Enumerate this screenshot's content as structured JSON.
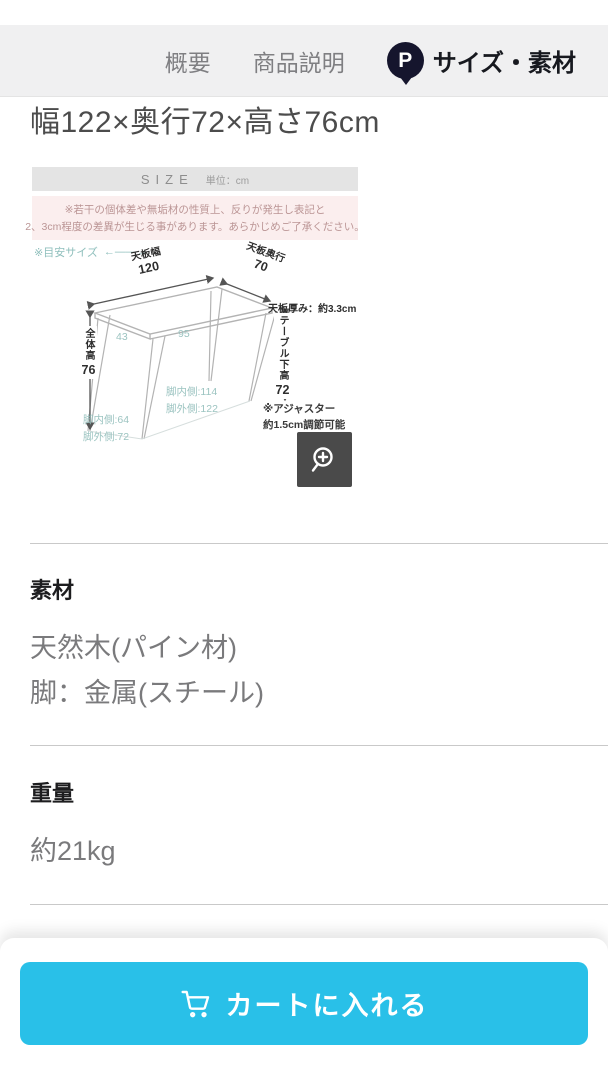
{
  "nav": {
    "tabs": [
      {
        "label": "概要"
      },
      {
        "label": "商品説明"
      },
      {
        "label": "サイズ・素材"
      }
    ],
    "point_badge": "P"
  },
  "size_section": {
    "dimensions_text": "幅122×奥行72×高さ76cm",
    "figure": {
      "header_title": "SIZE",
      "header_unit": "単位：cm",
      "notice_lines": [
        "※若干の個体差や無垢材の性質上、反りが発生し表記と",
        "2、3cm程度の差異が生じる事があります。あらかじめご了承ください。"
      ],
      "guide_note": "※目安サイズ",
      "guide_arrow": "←――→",
      "labels": {
        "top_width_name": "天板幅",
        "top_width_value": "120",
        "top_depth_name": "天板奥行",
        "top_depth_value": "70",
        "thickness": "天板厚み：約3.3cm",
        "overall_height_name": "全体高",
        "overall_height_value": "76",
        "under_table_height_name": "テーブル下高",
        "under_table_height_value": "72",
        "leg_gap_side": "43",
        "leg_gap_center": "95",
        "leg_inner_width": "脚内側:114",
        "leg_outer_width": "脚外側:122",
        "leg_inner_depth": "脚内側:64",
        "leg_outer_depth": "脚外側:72",
        "adjuster_line1": "※アジャスター",
        "adjuster_line2": "約1.5cm調節可能"
      }
    }
  },
  "material_section": {
    "heading": "素材",
    "line1": "天然木(パイン材)",
    "line2": "脚：金属(スチール)"
  },
  "weight_section": {
    "heading": "重量",
    "value": "約21kg"
  },
  "cart_bar": {
    "button_label": "カートに入れる"
  },
  "colors": {
    "accent_cyan": "#29c0e8",
    "teal_note": "#8fbfbc",
    "notice_pink_bg": "#fbeeee",
    "notice_pink_text": "#bb9595",
    "badge_dark": "#15152d",
    "zoom_button_bg": "#4a4a4a",
    "nav_bg": "#f0f0f1"
  }
}
